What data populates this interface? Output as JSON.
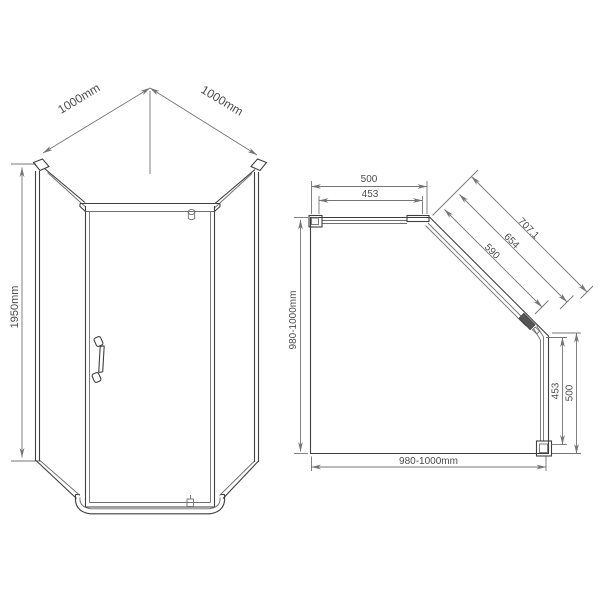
{
  "colors": {
    "background": "#ffffff",
    "outline_line": "#3f3f3f",
    "glass_line": "#6f6f6f",
    "dimension_line": "#757575",
    "dimension_text": "#4d4d4d",
    "hinge_fill": "#555555"
  },
  "front_view": {
    "dim_width_left": "1000mm",
    "dim_width_right": "1000mm",
    "dim_height": "1950mm"
  },
  "plan_view": {
    "dim_top_outer": "500",
    "dim_top_inner": "453",
    "dim_diagonal_outer": "707.1",
    "dim_diagonal_middle": "654",
    "dim_diagonal_inner": "590",
    "dim_left_depth": "980-1000mm",
    "dim_right_inner": "453",
    "dim_right_outer": "500",
    "dim_bottom_width": "980-1000mm"
  }
}
